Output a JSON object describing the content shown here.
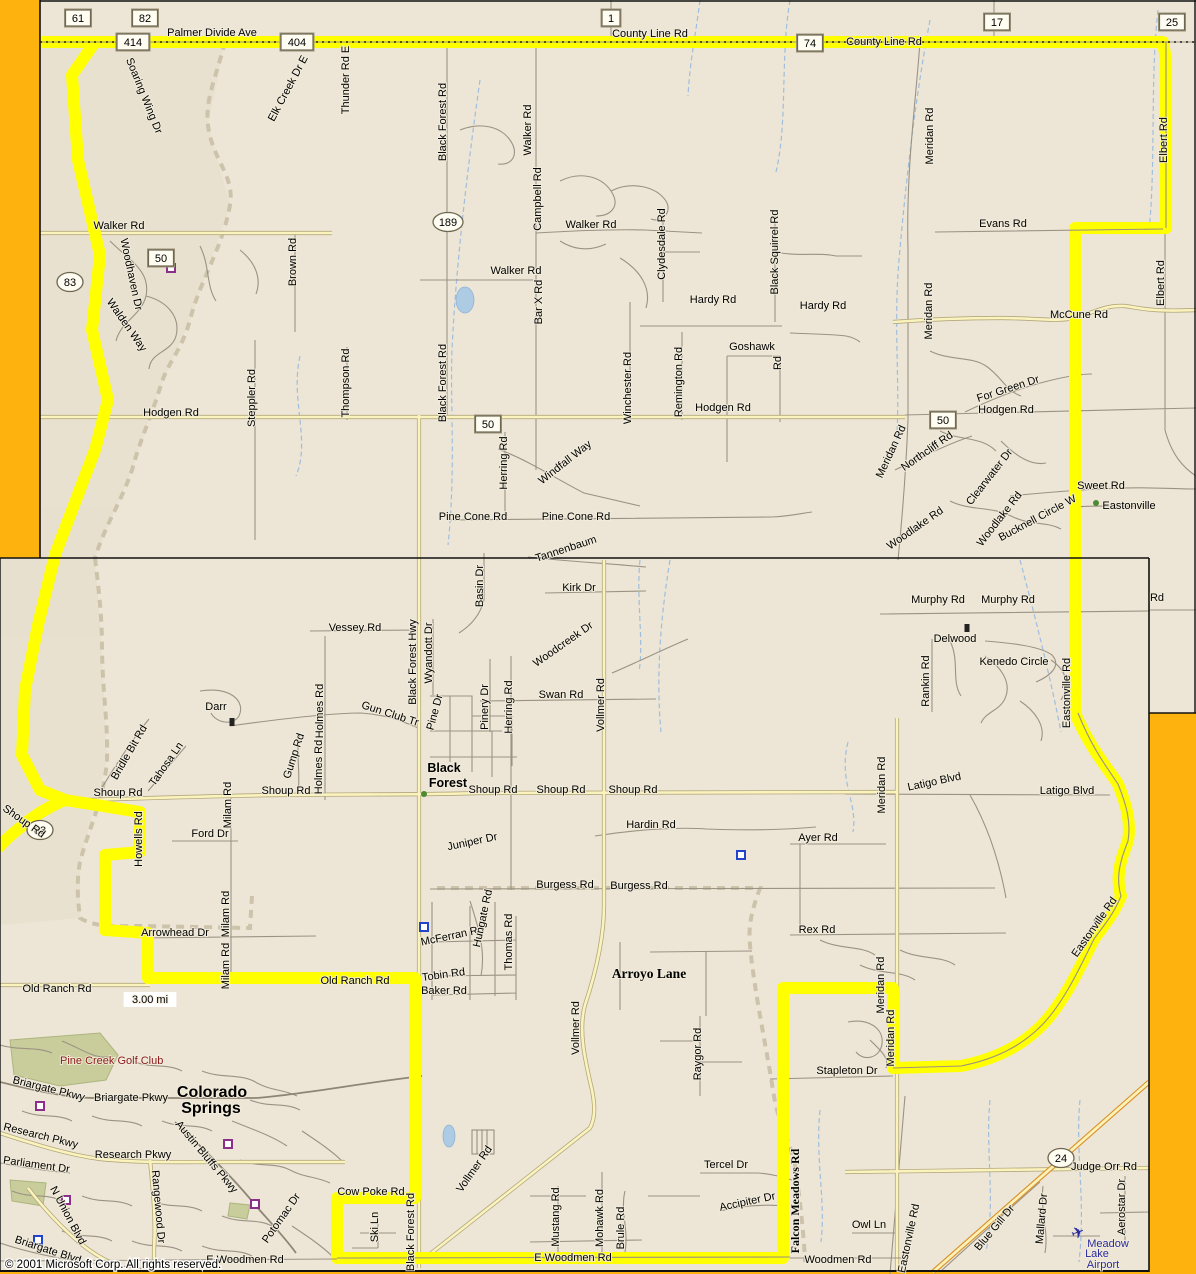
{
  "map": {
    "copyright": "© 2001 Microsoft Corp. All rights reserved.",
    "scale_label": "3.00 mi",
    "colors": {
      "route_highlight": "#FFFF00",
      "window_gold": "#FDB20D",
      "map_background": "#EDE6D7",
      "minor_road": "#9B9283",
      "major_road_fill": "#FBF3BE",
      "major_road_casing": "#B3A87C",
      "highway_casing": "#D98F2B",
      "water": "#9FBEDC",
      "golf_green": "#C8CD9B",
      "place_red": "#8B1A1A",
      "airport_blue": "#2A2A9E"
    },
    "shields": {
      "rect": [
        {
          "n": "61",
          "x": 78,
          "y": 18
        },
        {
          "n": "82",
          "x": 145,
          "y": 18
        },
        {
          "n": "414",
          "x": 133,
          "y": 42
        },
        {
          "n": "404",
          "x": 297,
          "y": 42
        },
        {
          "n": "1",
          "x": 611,
          "y": 18
        },
        {
          "n": "74",
          "x": 810,
          "y": 43
        },
        {
          "n": "17",
          "x": 997,
          "y": 22
        },
        {
          "n": "25",
          "x": 1172,
          "y": 22
        },
        {
          "n": "50",
          "x": 161,
          "y": 258
        },
        {
          "n": "50",
          "x": 488,
          "y": 424
        },
        {
          "n": "50",
          "x": 943,
          "y": 420
        }
      ],
      "oval": [
        {
          "n": "83",
          "x": 70,
          "y": 282
        },
        {
          "n": "83",
          "x": 40,
          "y": 830
        },
        {
          "n": "189",
          "x": 448,
          "y": 222
        },
        {
          "n": "24",
          "x": 1061,
          "y": 1158
        }
      ]
    },
    "towns": [
      {
        "t": "Eastonville",
        "x": 1129,
        "y": 509
      },
      {
        "t": "Black",
        "x": 444,
        "y": 772,
        "b": 1,
        "s": 12.5
      },
      {
        "t": "Forest",
        "x": 448,
        "y": 787,
        "b": 1,
        "s": 12.5
      },
      {
        "t": "Arroyo Lane",
        "x": 649,
        "y": 978,
        "b": 1,
        "f": "serif",
        "s": 13.5
      },
      {
        "t": "Colorado",
        "x": 212,
        "y": 1097,
        "b": 1,
        "s": 16
      },
      {
        "t": "Springs",
        "x": 211,
        "y": 1113,
        "b": 1,
        "s": 16
      },
      {
        "t": "Pine Creek Golf Club",
        "x": 60,
        "y": 1064,
        "c": "#8B1A1A",
        "a": "start",
        "xs": 8
      },
      {
        "t": "Meadow",
        "x": 1108,
        "y": 1247,
        "c": "#2A2A9E"
      },
      {
        "t": "Lake",
        "x": 1097,
        "y": 1257,
        "c": "#2A2A9E"
      },
      {
        "t": "Airport",
        "x": 1103,
        "y": 1268,
        "c": "#2A2A9E"
      }
    ],
    "labels": [
      {
        "t": "Palmer Divide Ave",
        "x": 212,
        "y": 36
      },
      {
        "t": "County Line Rd",
        "x": 650,
        "y": 37
      },
      {
        "t": "County Line Rd",
        "x": 884,
        "y": 45
      },
      {
        "t": "Soaring Wing Dr",
        "x": 141,
        "y": 97,
        "r": 68
      },
      {
        "t": "Elk Creek Dr E",
        "x": 291,
        "y": 90,
        "r": -62
      },
      {
        "t": "Thunder Rd E",
        "x": 349,
        "y": 80,
        "r": -90
      },
      {
        "t": "Walker Rd",
        "x": 119,
        "y": 229
      },
      {
        "t": "Woodhaven Dr",
        "x": 128,
        "y": 275,
        "r": 78
      },
      {
        "t": "Walden Way",
        "x": 124,
        "y": 327,
        "r": 55
      },
      {
        "t": "Brown Rd",
        "x": 296,
        "y": 262,
        "r": -90
      },
      {
        "t": "Steppler Rd",
        "x": 255,
        "y": 398,
        "r": -90
      },
      {
        "t": "Thompson Rd",
        "x": 349,
        "y": 383,
        "r": -90
      },
      {
        "t": "Black Forest Rd",
        "x": 446,
        "y": 122,
        "r": -90
      },
      {
        "t": "Black Forest Rd",
        "x": 446,
        "y": 383,
        "r": -90
      },
      {
        "t": "Walker Rd",
        "x": 531,
        "y": 130,
        "r": -90
      },
      {
        "t": "Campbell Rd",
        "x": 541,
        "y": 199,
        "r": -90
      },
      {
        "t": "Walker Rd",
        "x": 591,
        "y": 228
      },
      {
        "t": "Walker Rd",
        "x": 516,
        "y": 274
      },
      {
        "t": "Bar X Rd",
        "x": 542,
        "y": 302,
        "r": -90
      },
      {
        "t": "Clydesdale Rd",
        "x": 665,
        "y": 244,
        "r": -90
      },
      {
        "t": "Black Squirrel Rd",
        "x": 778,
        "y": 252,
        "r": -90
      },
      {
        "t": "Hardy Rd",
        "x": 713,
        "y": 303
      },
      {
        "t": "Hardy Rd",
        "x": 823,
        "y": 309
      },
      {
        "t": "Goshawk",
        "x": 752,
        "y": 350
      },
      {
        "t": "Rd",
        "x": 781,
        "y": 363,
        "r": -90
      },
      {
        "t": "Winchester Rd",
        "x": 631,
        "y": 388,
        "r": -90
      },
      {
        "t": "Remington Rd",
        "x": 682,
        "y": 382,
        "r": -90
      },
      {
        "t": "Hodgen Rd",
        "x": 171,
        "y": 416
      },
      {
        "t": "Hodgen Rd",
        "x": 723,
        "y": 411
      },
      {
        "t": "Hodgen Rd",
        "x": 1006,
        "y": 413
      },
      {
        "t": "Evans Rd",
        "x": 1003,
        "y": 227
      },
      {
        "t": "Meridan Rd",
        "x": 933,
        "y": 136,
        "r": -90
      },
      {
        "t": "Meridan Rd",
        "x": 932,
        "y": 311,
        "r": -90
      },
      {
        "t": "Meridan Rd",
        "x": 894,
        "y": 453,
        "r": -65
      },
      {
        "t": "McCune Rd",
        "x": 1079,
        "y": 318
      },
      {
        "t": "Elbert Rd",
        "x": 1167,
        "y": 140,
        "r": -90
      },
      {
        "t": "Elbert Rd",
        "x": 1164,
        "y": 283,
        "r": -90
      },
      {
        "t": "For Green Dr",
        "x": 1009,
        "y": 392,
        "r": -18
      },
      {
        "t": "Northcliff Rd",
        "x": 929,
        "y": 454,
        "r": -35
      },
      {
        "t": "Clearwater Dr",
        "x": 992,
        "y": 479,
        "r": -52
      },
      {
        "t": "Woodlake Rd",
        "x": 1002,
        "y": 521,
        "r": -52
      },
      {
        "t": "Woodlake Rd",
        "x": 917,
        "y": 531,
        "r": -35
      },
      {
        "t": "Bucknell Circle W",
        "x": 1039,
        "y": 521,
        "r": -28
      },
      {
        "t": "Sweet Rd",
        "x": 1101,
        "y": 489
      },
      {
        "t": "Windfall Way",
        "x": 567,
        "y": 465,
        "r": -38
      },
      {
        "t": "Herring Rd",
        "x": 507,
        "y": 463,
        "r": -90
      },
      {
        "t": "Pine Cone Rd",
        "x": 473,
        "y": 520
      },
      {
        "t": "Pine Cone Rd",
        "x": 576,
        "y": 520
      },
      {
        "t": "Tannenbaum",
        "x": 567,
        "y": 552,
        "r": -18
      },
      {
        "t": "Basin Dr",
        "x": 483,
        "y": 586,
        "r": -90
      },
      {
        "t": "Kirk Dr",
        "x": 579,
        "y": 591
      },
      {
        "t": "Murphy Rd",
        "x": 938,
        "y": 603
      },
      {
        "t": "Murphy Rd",
        "x": 1008,
        "y": 603
      },
      {
        "t": "Delwood",
        "x": 955,
        "y": 642
      },
      {
        "t": "Kenedo Circle",
        "x": 1014,
        "y": 665
      },
      {
        "t": "Rankin Rd",
        "x": 929,
        "y": 681,
        "r": -90
      },
      {
        "t": "Eastonville Rd",
        "x": 1070,
        "y": 693,
        "r": -90
      },
      {
        "t": "Rd",
        "x": 1157,
        "y": 601
      },
      {
        "t": "Vessey Rd",
        "x": 355,
        "y": 631
      },
      {
        "t": "Black Forest Hwy",
        "x": 416,
        "y": 662,
        "r": -90
      },
      {
        "t": "Wyandott Dr",
        "x": 432,
        "y": 653,
        "r": -90
      },
      {
        "t": "Holmes Rd",
        "x": 323,
        "y": 711,
        "r": -90
      },
      {
        "t": "Holmes Rd",
        "x": 322,
        "y": 767,
        "r": -90
      },
      {
        "t": "Gun Club Tr",
        "x": 389,
        "y": 717,
        "r": 18
      },
      {
        "t": "Pine Dr",
        "x": 438,
        "y": 713,
        "r": -75
      },
      {
        "t": "Pinery Dr",
        "x": 488,
        "y": 707,
        "r": -90
      },
      {
        "t": "Herring Rd",
        "x": 512,
        "y": 707,
        "r": -90
      },
      {
        "t": "Swan Rd",
        "x": 561,
        "y": 698
      },
      {
        "t": "Woodcreek Dr",
        "x": 565,
        "y": 647,
        "r": -35
      },
      {
        "t": "Vollmer Rd",
        "x": 604,
        "y": 705,
        "r": -90
      },
      {
        "t": "Shoup Rd",
        "x": 118,
        "y": 796
      },
      {
        "t": "Shoup Rd",
        "x": 286,
        "y": 794
      },
      {
        "t": "Shoup Rd",
        "x": 493,
        "y": 793
      },
      {
        "t": "Shoup Rd",
        "x": 561,
        "y": 793
      },
      {
        "t": "Shoup Rd",
        "x": 633,
        "y": 793
      },
      {
        "t": "Shoup Rd",
        "x": 22,
        "y": 824,
        "r": 35
      },
      {
        "t": "Howells Rd",
        "x": 142,
        "y": 839,
        "r": -90
      },
      {
        "t": "Bridle Bit Rd",
        "x": 132,
        "y": 754,
        "r": -60
      },
      {
        "t": "Tahosa Ln",
        "x": 169,
        "y": 766,
        "r": -55
      },
      {
        "t": "Darr",
        "x": 216,
        "y": 710
      },
      {
        "t": "Milam Rd",
        "x": 231,
        "y": 805,
        "r": -90
      },
      {
        "t": "Milam Rd",
        "x": 229,
        "y": 914,
        "r": -90
      },
      {
        "t": "Milam Rd",
        "x": 229,
        "y": 966,
        "r": -90
      },
      {
        "t": "Gump Rd",
        "x": 297,
        "y": 757,
        "r": -72
      },
      {
        "t": "Ford Dr",
        "x": 210,
        "y": 837
      },
      {
        "t": "Juniper Dr",
        "x": 473,
        "y": 845,
        "r": -12
      },
      {
        "t": "Hardin Rd",
        "x": 651,
        "y": 828
      },
      {
        "t": "Burgess Rd",
        "x": 565,
        "y": 888
      },
      {
        "t": "Burgess Rd",
        "x": 639,
        "y": 889
      },
      {
        "t": "Ayer Rd",
        "x": 818,
        "y": 841
      },
      {
        "t": "Rex Rd",
        "x": 817,
        "y": 933
      },
      {
        "t": "Latigo Blvd",
        "x": 935,
        "y": 785,
        "r": -12
      },
      {
        "t": "Latigo Blvd",
        "x": 1067,
        "y": 794
      },
      {
        "t": "Meridan Rd",
        "x": 885,
        "y": 785,
        "r": -90
      },
      {
        "t": "Meridan Rd",
        "x": 884,
        "y": 985,
        "r": -90
      },
      {
        "t": "Meridan Rd",
        "x": 894,
        "y": 1038,
        "r": -90
      },
      {
        "t": "Eastonville Rd",
        "x": 1097,
        "y": 929,
        "r": -55
      },
      {
        "t": "Stapleton Dr",
        "x": 847,
        "y": 1074
      },
      {
        "t": "Raygor Rd",
        "x": 701,
        "y": 1054,
        "r": -90
      },
      {
        "t": "Old Ranch Rd",
        "x": 57,
        "y": 992
      },
      {
        "t": "Old Ranch Rd",
        "x": 355,
        "y": 984
      },
      {
        "t": "Arrowhead Dr",
        "x": 175,
        "y": 936
      },
      {
        "t": "McFerran Rd",
        "x": 453,
        "y": 939,
        "r": -12
      },
      {
        "t": "Tobin Rd",
        "x": 444,
        "y": 978,
        "r": -8
      },
      {
        "t": "Baker Rd",
        "x": 444,
        "y": 994
      },
      {
        "t": "Hungate Rd",
        "x": 486,
        "y": 919,
        "r": -78
      },
      {
        "t": "Thomas Rd",
        "x": 512,
        "y": 942,
        "r": -90
      },
      {
        "t": "Vollmer Rd",
        "x": 579,
        "y": 1028,
        "r": -90
      },
      {
        "t": "Vollmer Rd",
        "x": 477,
        "y": 1171,
        "r": -55
      },
      {
        "t": "Cow Poke Rd",
        "x": 371,
        "y": 1195
      },
      {
        "t": "Ski Ln",
        "x": 378,
        "y": 1227,
        "r": -90
      },
      {
        "t": "Black Forest Rd",
        "x": 414,
        "y": 1232,
        "r": -90
      },
      {
        "t": "Mustang Rd",
        "x": 559,
        "y": 1217,
        "r": -90
      },
      {
        "t": "Mohawk Rd",
        "x": 603,
        "y": 1218,
        "r": -90
      },
      {
        "t": "Brule Rd",
        "x": 624,
        "y": 1228,
        "r": -90
      },
      {
        "t": "E Woodmen Rd",
        "x": 573,
        "y": 1261
      },
      {
        "t": "E Woodmen Rd",
        "x": 245,
        "y": 1263
      },
      {
        "t": "Woodmen Rd",
        "x": 838,
        "y": 1263
      },
      {
        "t": "Owl Ln",
        "x": 869,
        "y": 1228
      },
      {
        "t": "Eastonville Rd",
        "x": 912,
        "y": 1239,
        "r": -78
      },
      {
        "t": "Blue Gill Dr",
        "x": 997,
        "y": 1230,
        "r": -50
      },
      {
        "t": "Mallard Dr",
        "x": 1045,
        "y": 1219,
        "r": -85
      },
      {
        "t": "Judge Orr Rd",
        "x": 1104,
        "y": 1170
      },
      {
        "t": "Aerostar Dr",
        "x": 1125,
        "y": 1207,
        "r": -90
      },
      {
        "t": "Tercel Dr",
        "x": 726,
        "y": 1168
      },
      {
        "t": "Accipiter Dr",
        "x": 748,
        "y": 1205,
        "r": -12
      },
      {
        "t": "Falcon Meadows Rd",
        "x": 799,
        "y": 1201,
        "r": -90,
        "b": 1,
        "f": "serif",
        "s": 12
      },
      {
        "t": "Briargate Pkwy",
        "x": 48,
        "y": 1092,
        "r": 14
      },
      {
        "t": "Briargate Pkwy",
        "x": 131,
        "y": 1101
      },
      {
        "t": "Research Pkwy",
        "x": 40,
        "y": 1139,
        "r": 14
      },
      {
        "t": "Research Pkwy",
        "x": 133,
        "y": 1158
      },
      {
        "t": "Parliament Dr",
        "x": 36,
        "y": 1168,
        "r": 8
      },
      {
        "t": "Austin Bluffs Pkwy",
        "x": 204,
        "y": 1159,
        "r": 50
      },
      {
        "t": "N Union Blvd",
        "x": 65,
        "y": 1217,
        "r": 62
      },
      {
        "t": "Rangewood Dr",
        "x": 155,
        "y": 1207,
        "r": 85
      },
      {
        "t": "Potomac Dr",
        "x": 284,
        "y": 1220,
        "r": -55
      },
      {
        "t": "Briargate Blvd",
        "x": 47,
        "y": 1253,
        "r": 18
      },
      {
        "t": "3.00 mi",
        "x": 150,
        "y": 1003,
        "bg": 1
      },
      {
        "t": "© 2001 Microsoft Corp. All rights reserved.",
        "x": 5,
        "y": 1268,
        "a": "start",
        "halo": 1,
        "s": 11.5
      }
    ],
    "route_paths": [
      "M40,42 L1163,42 L1166,60 L1166,228 L1075,228 L1075,713 C1090,748 1106,766 1118,784 C1127,806 1131,823 1128,841 C1119,863 1116,879 1121,896 C1113,916 1101,929 1094,939 C1076,976 1061,1006 1041,1026 C1021,1046 996,1059 961,1066 L893,1068 L893,988 L783,988 L783,1258 L337,1258 L337,1198 L415,1198 L415,978 L148,978 L148,933 L105,930 L105,855 L140,852 L140,812 L65,800 L40,790 L22,755 L25,690 L38,625 L55,555 L95,450 L108,400 L92,330 L100,255 L78,160 L72,75 L95,42 L40,42",
      "M65,800 C50,806 35,815 22,826 C12,834 5,840 0,846"
    ],
    "pois": {
      "purple_squares": [
        [
          171,
          268
        ],
        [
          40,
          1106
        ],
        [
          228,
          1144
        ],
        [
          66,
          1200
        ],
        [
          255,
          1204
        ]
      ],
      "blue_squares": [
        [
          741,
          855
        ],
        [
          424,
          927
        ],
        [
          38,
          1240
        ]
      ],
      "green_dots": [
        [
          424,
          794
        ],
        [
          1096,
          503
        ]
      ],
      "black_markers": [
        [
          232,
          722
        ],
        [
          967,
          628
        ]
      ],
      "airplane": [
        1078,
        1233
      ]
    }
  }
}
